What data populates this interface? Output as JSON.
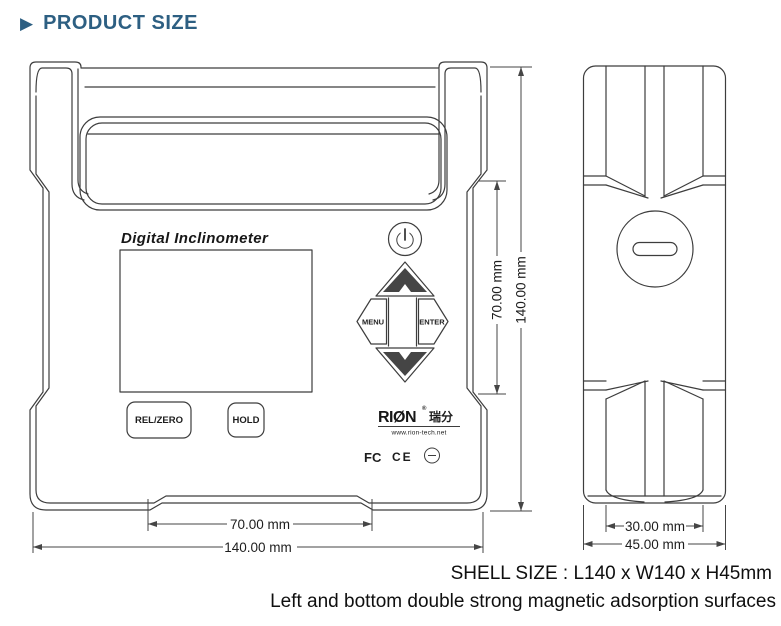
{
  "header": {
    "title": "PRODUCT SIZE",
    "arrow_icon": "▶"
  },
  "front_view": {
    "brand_label": "Digital Inclinometer",
    "buttons": {
      "menu": "MENU",
      "enter": "ENTER",
      "rel_zero": "REL/ZERO",
      "hold": "HOLD"
    },
    "logo": {
      "name": "RIØN",
      "registered": "®",
      "cn": "瑞分",
      "website": "www.rion-tech.net",
      "cert_fcc": "FC",
      "cert_ce": "CE"
    },
    "dims": {
      "width_inner": "70.00 mm",
      "width_outer": "140.00 mm",
      "height_inner": "70.00 mm",
      "height_outer": "140.00 mm"
    }
  },
  "side_view": {
    "dims": {
      "width_inner": "30.00 mm",
      "width_outer": "45.00 mm"
    }
  },
  "footer": {
    "shell_size": "SHELL SIZE : L140 x W140 x H45mm",
    "note": "Left and bottom double strong magnetic adsorption surfaces"
  },
  "colors": {
    "accent": "#2d5f82",
    "line": "#3d3d3d",
    "text": "#111111"
  }
}
